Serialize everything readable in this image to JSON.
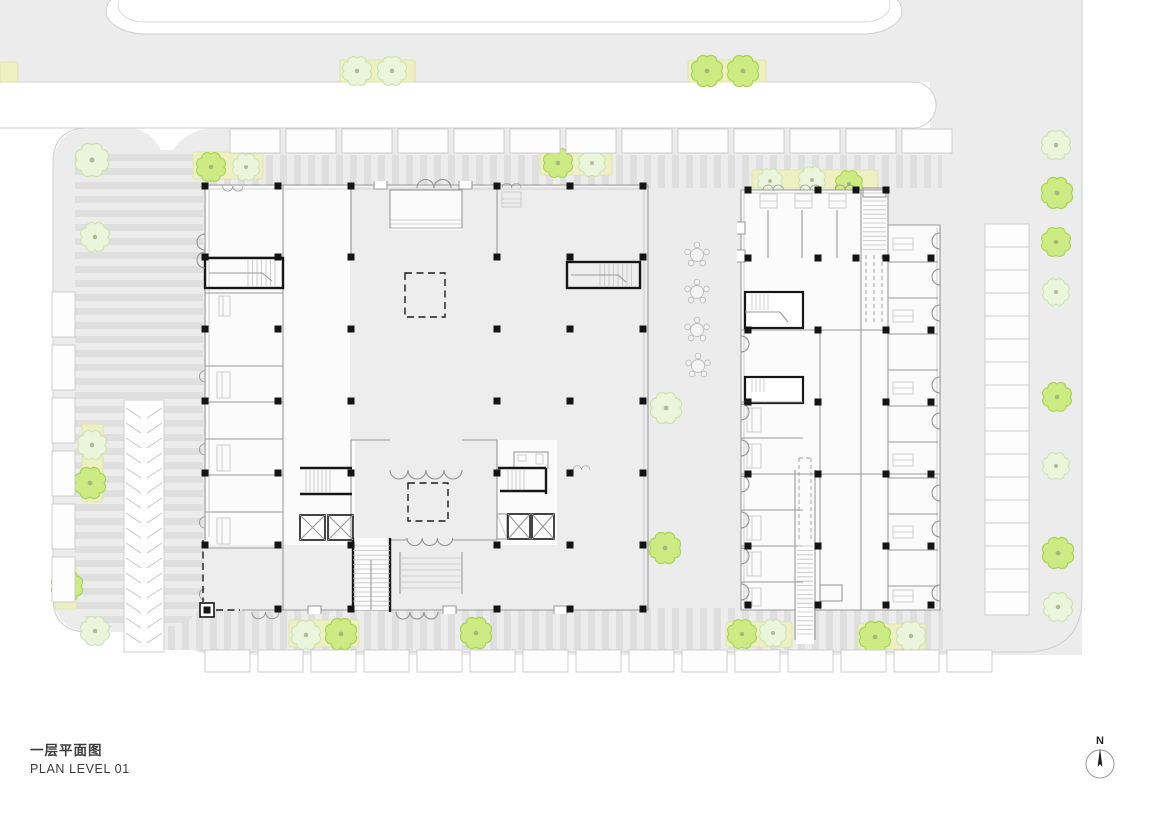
{
  "title": {
    "line1_zh": "一层平面图",
    "line2_en": "PLAN LEVEL 01"
  },
  "compass": {
    "label": "N"
  },
  "palette": {
    "site_gray": "#ececec",
    "stripe_gray": "#dfdfdf",
    "outline": "#cfcfcf",
    "wall": "#9a9a9a",
    "black": "#161616",
    "tree_pale_fill": "#eaf5dc",
    "tree_pale_stroke": "#cde3b2",
    "tree_bright_fill": "#cdeb83",
    "tree_bright_stroke": "#abd35c",
    "planting_fill": "#eef0c2",
    "stall_fill": "#fdfdfd"
  },
  "planting_strips": [
    {
      "x": 340,
      "y": 60,
      "w": 75,
      "h": 22
    },
    {
      "x": 688,
      "y": 60,
      "w": 78,
      "h": 22
    },
    {
      "x": 0,
      "y": 62,
      "w": 18,
      "h": 20
    },
    {
      "x": 193,
      "y": 152,
      "w": 70,
      "h": 27
    },
    {
      "x": 540,
      "y": 152,
      "w": 72,
      "h": 23
    },
    {
      "x": 752,
      "y": 170,
      "w": 126,
      "h": 18
    },
    {
      "x": 82,
      "y": 424,
      "w": 21,
      "h": 78
    },
    {
      "x": 55,
      "y": 565,
      "w": 22,
      "h": 44
    },
    {
      "x": 289,
      "y": 620,
      "w": 70,
      "h": 27
    },
    {
      "x": 726,
      "y": 622,
      "w": 66,
      "h": 25
    },
    {
      "x": 858,
      "y": 624,
      "w": 68,
      "h": 25
    }
  ],
  "trees": [
    {
      "x": 357,
      "y": 71,
      "r": 13,
      "shade": "pale"
    },
    {
      "x": 392,
      "y": 71,
      "r": 13,
      "shade": "pale"
    },
    {
      "x": 707,
      "y": 71,
      "r": 14,
      "shade": "bright"
    },
    {
      "x": 743,
      "y": 71,
      "r": 14,
      "shade": "bright"
    },
    {
      "x": 92,
      "y": 160,
      "r": 15,
      "shade": "pale"
    },
    {
      "x": 211,
      "y": 167,
      "r": 13,
      "shade": "bright"
    },
    {
      "x": 246,
      "y": 167,
      "r": 12,
      "shade": "pale"
    },
    {
      "x": 558,
      "y": 163,
      "r": 13,
      "shade": "bright"
    },
    {
      "x": 592,
      "y": 163,
      "r": 12,
      "shade": "pale"
    },
    {
      "x": 770,
      "y": 181,
      "r": 11,
      "shade": "pale"
    },
    {
      "x": 812,
      "y": 180,
      "r": 12,
      "shade": "pale"
    },
    {
      "x": 849,
      "y": 184,
      "r": 12,
      "shade": "bright"
    },
    {
      "x": 95,
      "y": 237,
      "r": 13,
      "shade": "pale"
    },
    {
      "x": 92,
      "y": 445,
      "r": 13,
      "shade": "pale"
    },
    {
      "x": 90,
      "y": 483,
      "r": 14,
      "shade": "bright"
    },
    {
      "x": 67,
      "y": 586,
      "r": 14,
      "shade": "bright"
    },
    {
      "x": 95,
      "y": 631,
      "r": 13,
      "shade": "pale"
    },
    {
      "x": 666,
      "y": 408,
      "r": 14,
      "shade": "pale"
    },
    {
      "x": 665,
      "y": 548,
      "r": 14,
      "shade": "bright"
    },
    {
      "x": 306,
      "y": 635,
      "r": 13,
      "shade": "pale"
    },
    {
      "x": 341,
      "y": 634,
      "r": 14,
      "shade": "bright"
    },
    {
      "x": 476,
      "y": 633,
      "r": 14,
      "shade": "bright"
    },
    {
      "x": 742,
      "y": 634,
      "r": 13,
      "shade": "bright"
    },
    {
      "x": 773,
      "y": 633,
      "r": 12,
      "shade": "pale"
    },
    {
      "x": 875,
      "y": 637,
      "r": 14,
      "shade": "bright"
    },
    {
      "x": 911,
      "y": 636,
      "r": 13,
      "shade": "pale"
    },
    {
      "x": 1056,
      "y": 145,
      "r": 13,
      "shade": "pale"
    },
    {
      "x": 1057,
      "y": 193,
      "r": 14,
      "shade": "bright"
    },
    {
      "x": 1056,
      "y": 242,
      "r": 13,
      "shade": "bright"
    },
    {
      "x": 1056,
      "y": 292,
      "r": 12,
      "shade": "pale"
    },
    {
      "x": 1057,
      "y": 397,
      "r": 13,
      "shade": "bright"
    },
    {
      "x": 1056,
      "y": 466,
      "r": 12,
      "shade": "pale"
    },
    {
      "x": 1058,
      "y": 553,
      "r": 14,
      "shade": "bright"
    },
    {
      "x": 1058,
      "y": 607,
      "r": 13,
      "shade": "pale"
    }
  ],
  "parking_rows": [
    {
      "name": "top-row",
      "x": 230,
      "y": 129,
      "w": 50,
      "h": 24,
      "pitch": 56,
      "count": 13,
      "axis": "x"
    },
    {
      "name": "bottom-row",
      "x": 205,
      "y": 650,
      "w": 45,
      "h": 22,
      "pitch": 53,
      "count": 15,
      "axis": "x"
    },
    {
      "name": "left-column",
      "x": 52,
      "y": 292,
      "w": 23,
      "h": 45,
      "pitch": 53,
      "count": 6,
      "axis": "y"
    },
    {
      "name": "right-column",
      "x": 985,
      "y": 224,
      "w": 44,
      "h": 23,
      "pitch": 23,
      "count": 17,
      "axis": "y"
    }
  ],
  "columns": {
    "left": {
      "xs": [
        205,
        278,
        351,
        424,
        497,
        570,
        643
      ],
      "ys": [
        186,
        257,
        329,
        401,
        473,
        545,
        609
      ],
      "skip": [
        "424,186",
        "424,257",
        "424,329",
        "424,401",
        "424,473",
        "424,545",
        "424,609",
        "205,609"
      ]
    },
    "right": {
      "xs": [
        748,
        818,
        856,
        886,
        931
      ],
      "ys": [
        190,
        258,
        330,
        402,
        474,
        546,
        605
      ],
      "skip": [
        "856,330",
        "856,402",
        "856,474",
        "856,546",
        "856,605",
        "931,190"
      ]
    }
  },
  "clusters": [
    {
      "x": 697,
      "y": 255
    },
    {
      "x": 697,
      "y": 292
    },
    {
      "x": 697,
      "y": 330
    },
    {
      "x": 698,
      "y": 366
    }
  ]
}
